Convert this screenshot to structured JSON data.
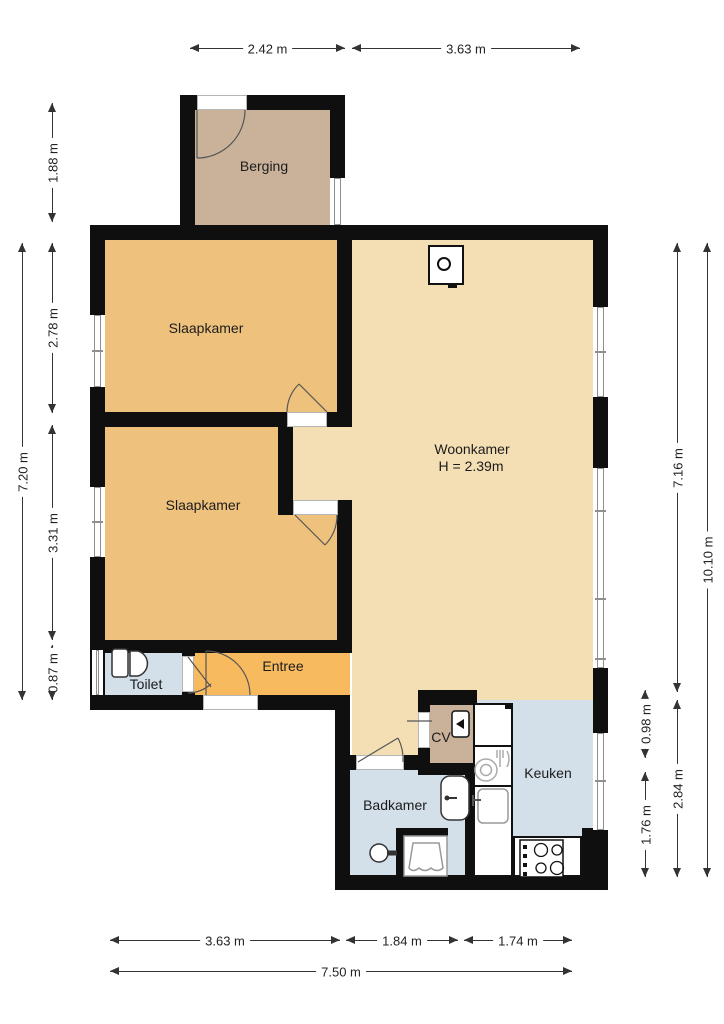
{
  "rooms": {
    "berging": "Berging",
    "slaapkamer1": "Slaapkamer",
    "slaapkamer2": "Slaapkamer",
    "woonkamer": "Woonkamer",
    "woonkamer_height": "H = 2.39m",
    "toilet": "Toilet",
    "entree": "Entree",
    "cv": "CV",
    "badkamer": "Badkamer",
    "keuken": "Keuken"
  },
  "dimensions": {
    "top_berging": "2.42 m",
    "top_woonkamer": "3.63 m",
    "left_berging": "1.88 m",
    "left_total": "7.20 m",
    "left_slaapkamer1": "2.78 m",
    "left_slaapkamer2": "3.31 m",
    "left_toilet": "0.87 m",
    "right_cv": "0.98 m",
    "right_badkamer": "1.76 m",
    "right_woonkamer": "7.16 m",
    "right_keuken": "2.84 m",
    "right_total": "10.10 m",
    "bottom_left": "3.63 m",
    "bottom_badkamer": "1.84 m",
    "bottom_keuken": "1.74 m",
    "bottom_total": "7.50 m"
  },
  "colors": {
    "wall": "#0f0f0f",
    "storage_tan": "#c9b299",
    "bedroom_orange": "#eec17d",
    "living_beige": "#f4deb4",
    "entry_orange": "#f8ba5f",
    "wet_room_blue": "#d3dfe9",
    "dimension_text": "#222222"
  },
  "icons": [
    "toilet-icon",
    "shower-icon",
    "bath-sink-icon",
    "kitchen-sink-icon",
    "dishwasher-icon",
    "fridge",
    "stove-icon",
    "boiler-icon",
    "fireplace-icon",
    "tap-fixture-icon",
    "door-arc",
    "window"
  ]
}
